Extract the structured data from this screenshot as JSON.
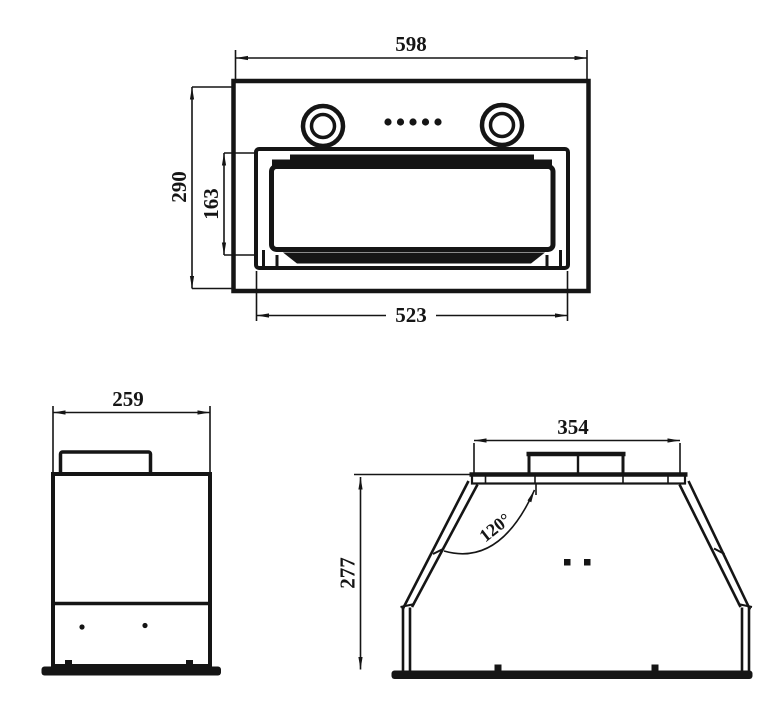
{
  "drawing": {
    "title": "range-hood-dimension-drawing",
    "ink_color": "#151515",
    "paper_color": "#ffffff",
    "front_view": {
      "overall_width": "598",
      "overall_height": "290",
      "panel_height": "163",
      "panel_width": "523"
    },
    "side_view": {
      "depth": "259"
    },
    "rear_view": {
      "top_width": "354",
      "body_height": "277",
      "slope_angle": "120°"
    }
  }
}
